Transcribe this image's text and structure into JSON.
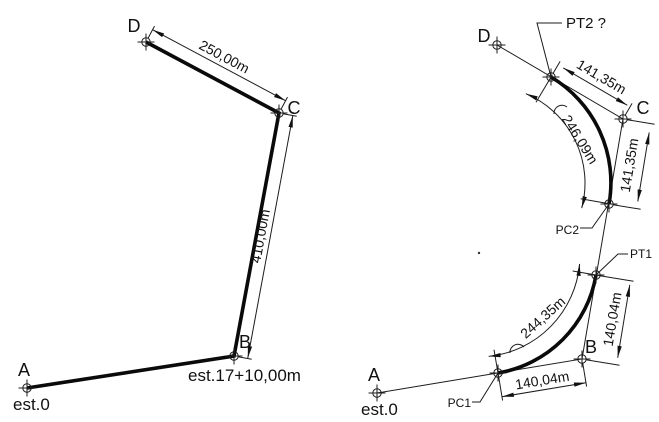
{
  "left_diagram": {
    "points": {
      "a": "A",
      "b": "B",
      "c": "C",
      "d": "D"
    },
    "stations": {
      "a": "est.0",
      "b": "est.17+10,00m"
    },
    "dims": {
      "dc": "250,00m",
      "bc": "410,00m"
    }
  },
  "right_diagram": {
    "points": {
      "a": "A",
      "b": "B",
      "c": "C",
      "d": "D"
    },
    "stations": {
      "a": "est.0"
    },
    "curve_points": {
      "pc1": "PC1",
      "pt1": "PT1",
      "pc2": "PC2",
      "pt2": "PT2 ?"
    },
    "dims": {
      "tangent1_bottom": "140,04m",
      "tangent1_right": "140,04m",
      "arc1_length": "244,35m",
      "tangent2_top": "141,35m",
      "tangent2_right": "141,35m",
      "arc2_length": "246,09m"
    }
  },
  "colors": {
    "ink": "#111111",
    "background": "#ffffff"
  }
}
